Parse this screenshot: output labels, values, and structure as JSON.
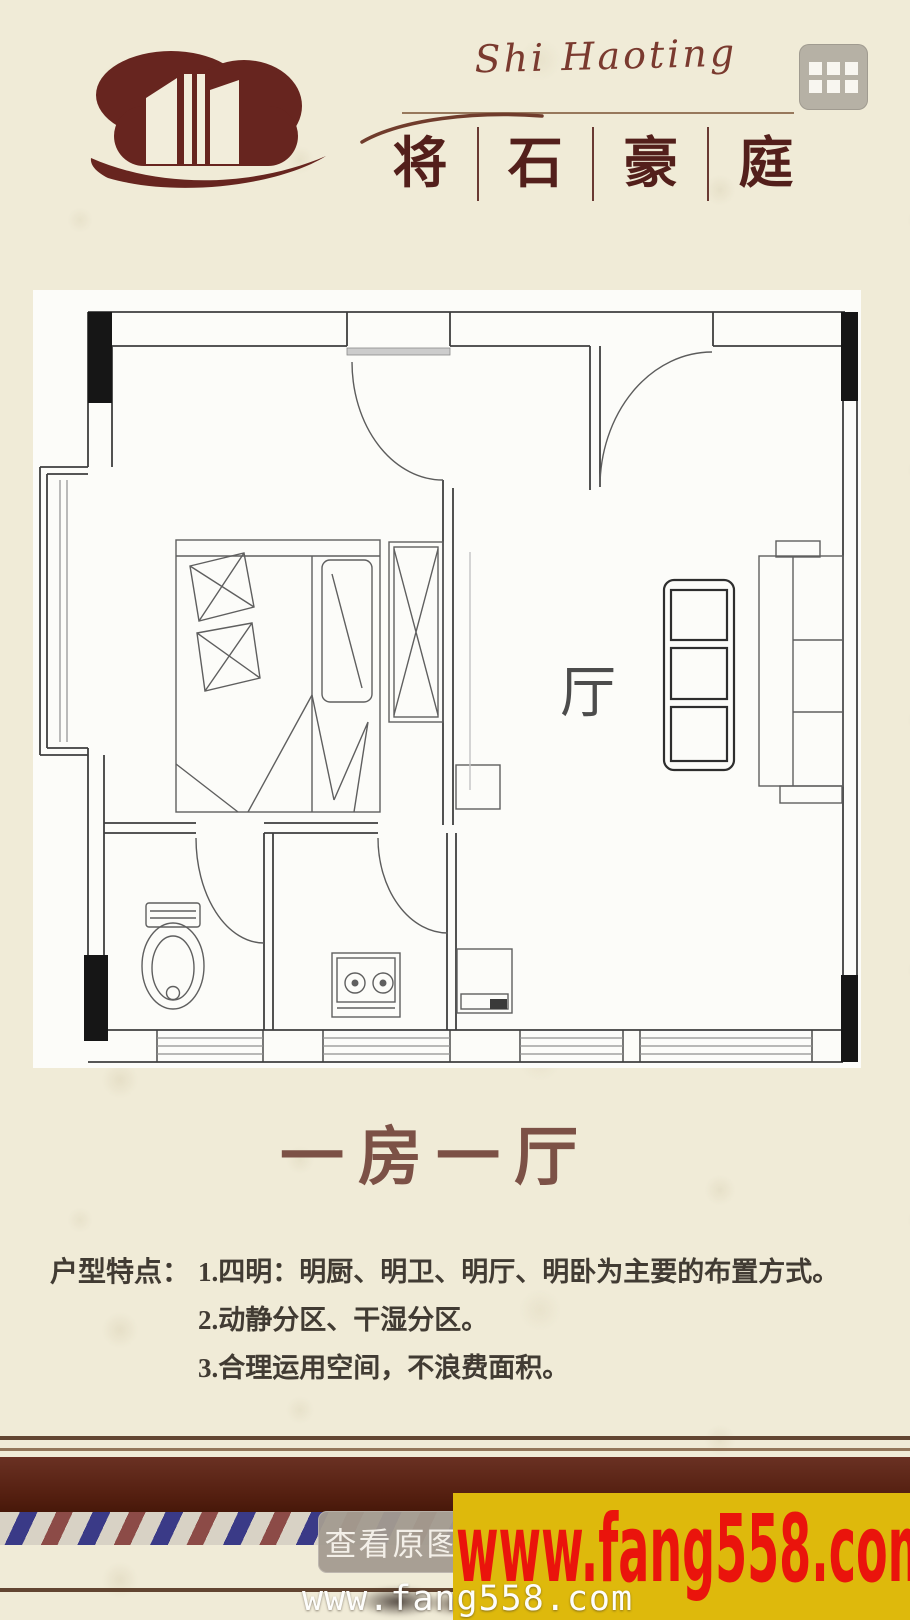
{
  "header": {
    "brand_script": "Shi Haoting",
    "brand_chars": [
      "将",
      "石",
      "豪",
      "庭"
    ]
  },
  "plan": {
    "room_label": "厅",
    "title": "一房一厅"
  },
  "features": {
    "label": "户型特点：",
    "items": [
      "1.四明：明厨、明卫、明厅、明卧为主要的布置方式。",
      "2.动静分区、干湿分区。",
      "3.合理运用空间，不浪费面积。"
    ]
  },
  "footer": {
    "view_original_label": "查看原图",
    "watermark_site": "www.fang558.com",
    "watermark_site_large": "www.fang558.com"
  },
  "colors": {
    "brand_maroon": "#67251f",
    "title_brown": "#7c5146",
    "band_maroon": "#541f10",
    "ribbon_blue": "#3a3a87",
    "ribbon_red": "#8c4b47",
    "watermark_yellow": "#deb90c",
    "watermark_red": "#ea140c"
  }
}
